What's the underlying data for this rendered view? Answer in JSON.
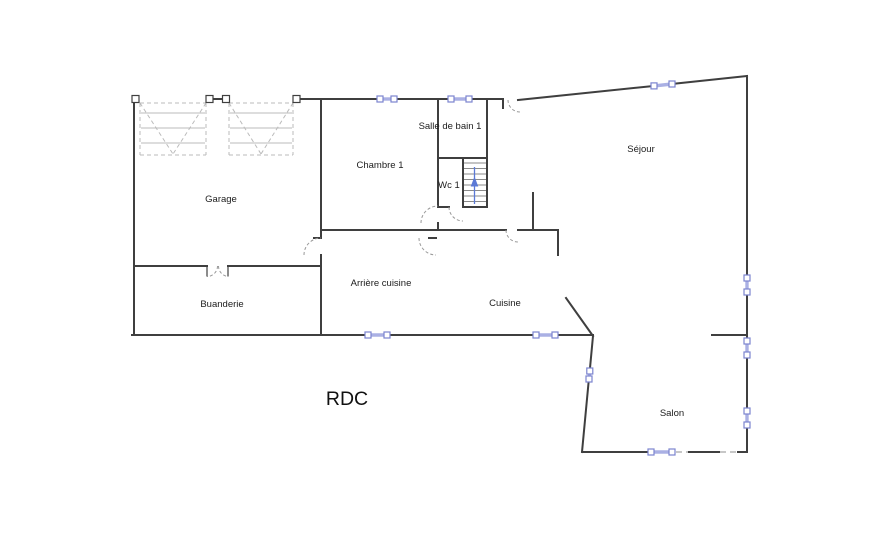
{
  "floor_plan": {
    "title": "RDC",
    "rooms": {
      "garage": {
        "label": "Garage"
      },
      "chambre_1": {
        "label": "Chambre 1"
      },
      "salle_de_bain_1": {
        "label": "Salle de bain 1"
      },
      "wc_1": {
        "label": "Wc 1"
      },
      "sejour": {
        "label": "Séjour"
      },
      "buanderie": {
        "label": "Buanderie"
      },
      "arriere_cuisine": {
        "label": "Arrière cuisine"
      },
      "cuisine": {
        "label": "Cuisine"
      },
      "salon": {
        "label": "Salon"
      }
    },
    "symbols": {
      "stairs_arrow_direction": "up",
      "window_count": 10,
      "garage_door_bays": 2
    },
    "colors": {
      "background": "#ffffff",
      "wall": "#3f3f3f",
      "window_frame": "#7b84cf",
      "window_glass": "#aab0e4",
      "door_arc": "#999999",
      "garage_door": "#bbbbbb",
      "stairs_arrow": "#5b79d6",
      "label_text": "#1c1c1c"
    }
  }
}
